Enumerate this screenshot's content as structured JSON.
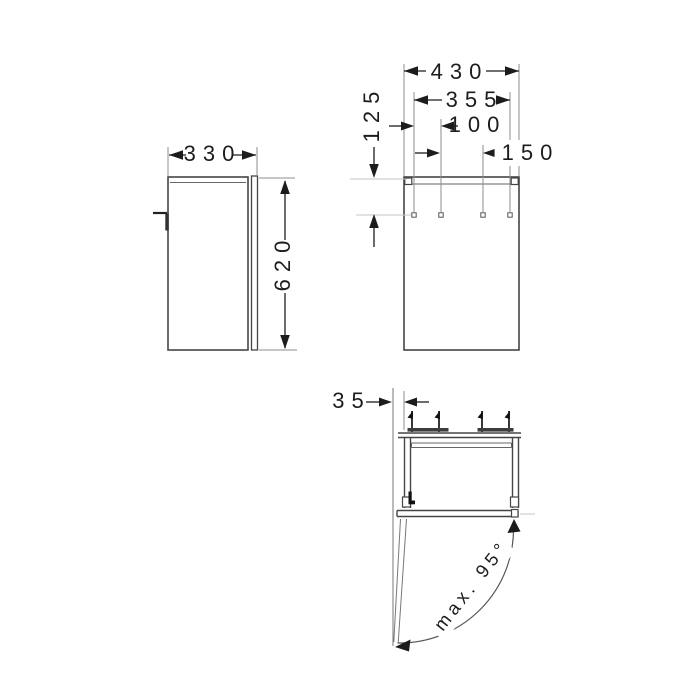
{
  "drawing_type": "furniture dimension drawing",
  "views": {
    "side": {
      "width_label": "330",
      "height_label": "620"
    },
    "front": {
      "width_label": "430",
      "mount_span_label": "355",
      "mount_hole_left_label": "100",
      "mount_hole_mid_label": "150",
      "mount_top_offset_label": "125"
    },
    "plan": {
      "side_clearance_label": "35",
      "door_opening_label": "max. 95°"
    }
  },
  "colors": {
    "ink": "#1c1c1c",
    "object_line": "#454545",
    "extension_line": "#8c8c8c",
    "background": "#ffffff"
  }
}
